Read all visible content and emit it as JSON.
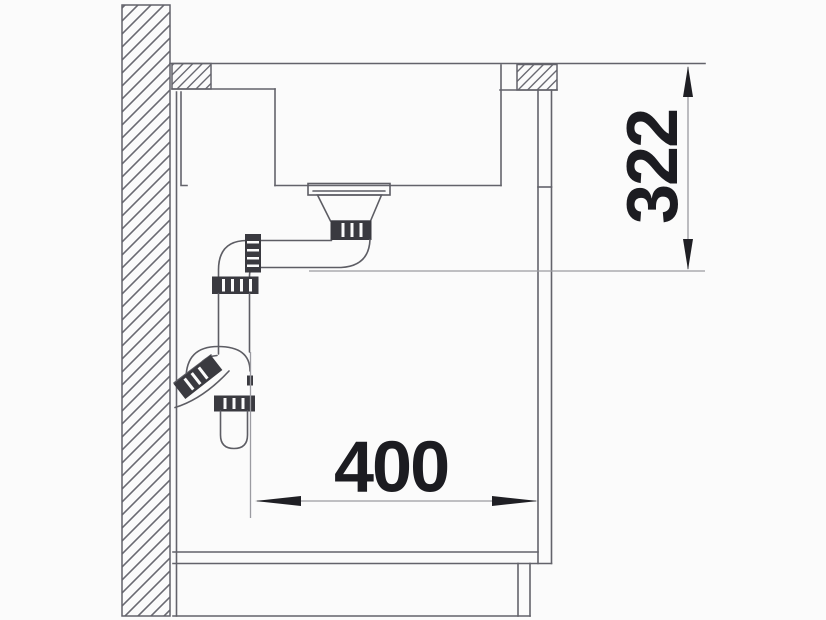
{
  "drawing_type": "sink-installation-side-section",
  "dimensions": {
    "vertical": {
      "value": "322",
      "orientation": "vertical"
    },
    "horizontal": {
      "value": "400",
      "orientation": "horizontal"
    }
  },
  "colors": {
    "background": "#fbfbfb",
    "structure_line": "#63636b",
    "pipe_line": "#5d5d64",
    "dimension_line": "#9b9ba1",
    "dimension_text": "#1c1c21",
    "fitting_dark": "#3a3a40"
  }
}
